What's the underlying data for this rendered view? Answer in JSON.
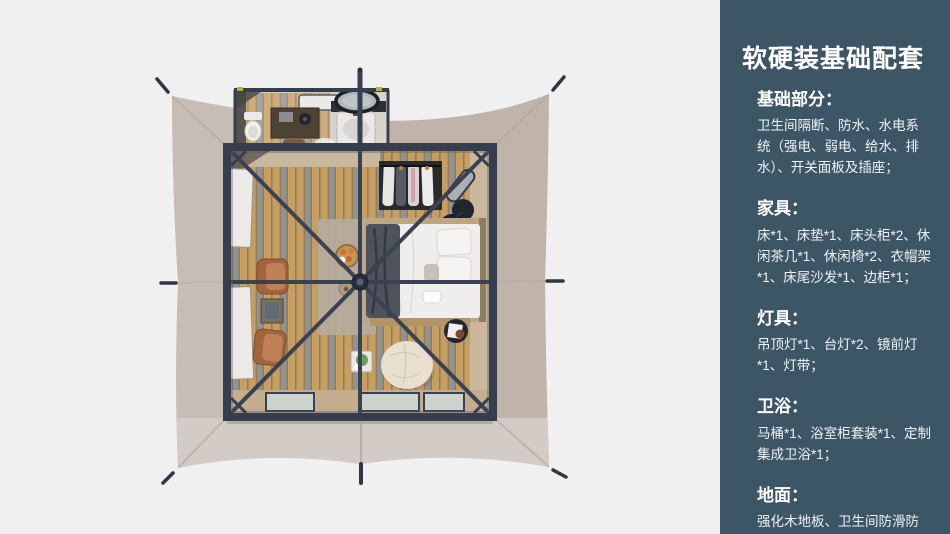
{
  "panel": {
    "title": "软硬装基础配套",
    "sections": [
      {
        "heading": "基础部分：",
        "body": "卫生间隔断、防水、水电系统（强电、弱电、给水、排水）、开关面板及插座；"
      },
      {
        "heading": "家具：",
        "body": "床*1、床垫*1、床头柜*2、休闲茶几*1、休闲椅*2、衣帽架*1、床尾沙发*1、边柜*1；"
      },
      {
        "heading": "灯具：",
        "body": "吊顶灯*1、台灯*2、镜前灯*1、灯带；"
      },
      {
        "heading": "卫浴：",
        "body": "马桶*1、浴室柜套装*1、定制集成卫浴*1；"
      },
      {
        "heading": "地面：",
        "body": "强化木地板、卫生间防滑防潮石塑板；"
      }
    ]
  },
  "colors": {
    "background": "#f0f0f1",
    "panel_bg": "#3d5666",
    "canvas": "#c8bdb4",
    "canvas_right": "#b9ada2",
    "canvas_apron": "#d3ccc6",
    "frame": "#363d4c",
    "beam": "#3a4252",
    "glass": "#ccd2cc",
    "bed_white": "#efeeec",
    "chair_leather": "#a4643f",
    "pouf": "#e9dfce"
  }
}
